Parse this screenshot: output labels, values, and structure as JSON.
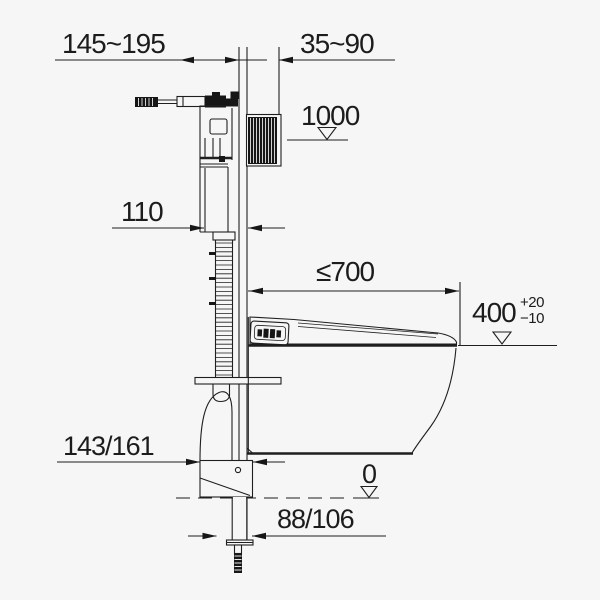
{
  "drawing": {
    "background_color": "#f6f6f6",
    "line_color": "#1f1f1f",
    "labels": {
      "depth_range": "145~195",
      "front_range": "35~90",
      "upper_level_ref": "1000",
      "pipe_offset": "110",
      "max_depth": "≤700",
      "seat_height": "400",
      "seat_height_tol_plus": "+20",
      "seat_height_tol_minus": "−10",
      "outlet_depth": "143/161",
      "floor_level_ref": "0",
      "outlet_offset": "88/106"
    }
  }
}
